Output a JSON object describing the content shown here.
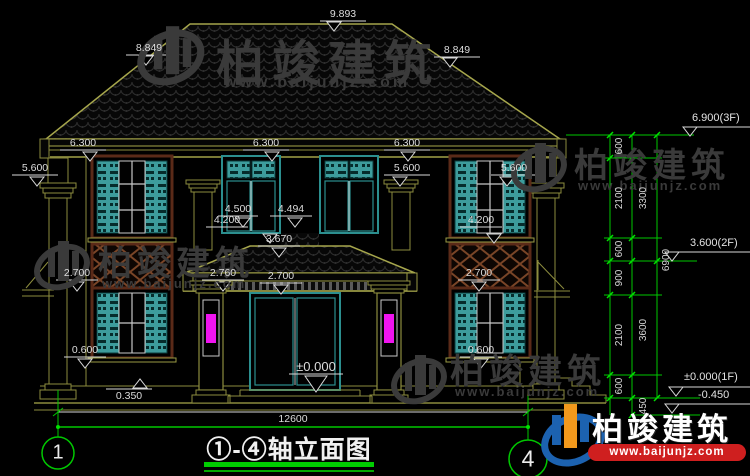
{
  "title": {
    "drawing": "①-④轴立面图"
  },
  "axis_bubbles": {
    "left": "1",
    "right": "4"
  },
  "dims": {
    "ridge": "9.893",
    "hip_left": "8.849",
    "hip_right": "8.849",
    "eave_left": "6.300",
    "eave_center": "6.300",
    "eave_right": "6.300",
    "lvl56_left": "5.600",
    "lvl56_mid": "5.600",
    "lvl56_right": "5.600",
    "sill_left": "4.500",
    "sill_right": "4.494",
    "lvl42_left": "4.200",
    "lvl42_right": "4.200",
    "porch_ridge": "3.670",
    "porch_beam": "2.760",
    "porch_clear": "2.700",
    "win_head_left": "2.700",
    "win_head_right": "2.700",
    "win_sill_left": "0.600",
    "win_sill_right": "0.600",
    "plinth": "0.350",
    "floor_door": "±0.000",
    "overall_width": "12600"
  },
  "levels": {
    "f3": "6.900(3F)",
    "f2": "3.600(2F)",
    "f1": "±0.000(1F)",
    "ground": "-0.450"
  },
  "chain": {
    "inner": [
      "600",
      "2100",
      "600",
      "900",
      "2100",
      "600",
      "450"
    ],
    "middle": [
      "3300",
      "3600"
    ],
    "overall": "6900"
  },
  "watermark": {
    "name": "柏竣建筑",
    "url": "www.baijunjz.com"
  },
  "brand": {
    "name": "柏竣建筑",
    "url": "www.baijunjz.com"
  }
}
